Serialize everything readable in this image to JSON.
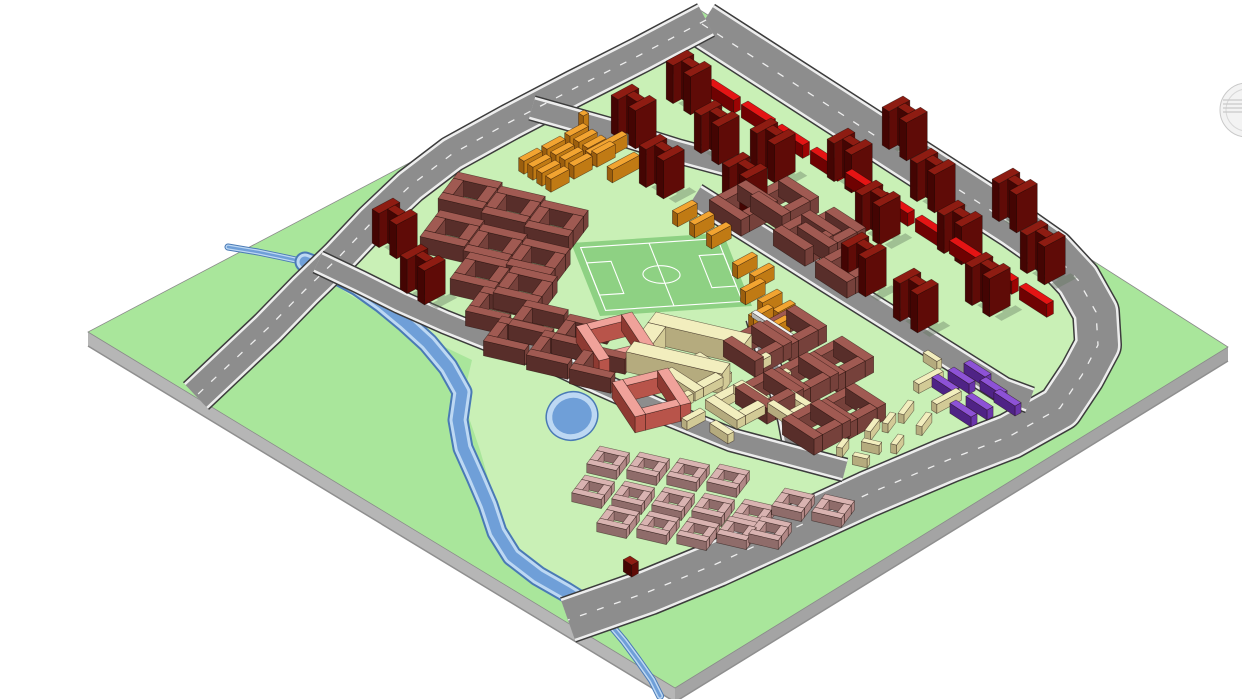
{
  "viewport": {
    "width": 1242,
    "height": 699,
    "background": "#ffffff",
    "type": "3d-axonometric-site-plan-viewport"
  },
  "icons": {
    "navigation_wheel": {
      "cx": 1247,
      "cy": 110,
      "r": 27,
      "stroke": "#c9c9c9",
      "fill": "#f3f3f3"
    }
  },
  "colors": {
    "terrain": "#a9e69b",
    "parcel": "#c9f0b6",
    "pitch": "#8ed183",
    "road": "#8d8d8d",
    "road_edge": "#3c3c3c",
    "sidewalk": "#ededed",
    "dash": "#ffffff",
    "plate_side_sw": "#b6b6b6",
    "plate_side_se": "#a4a4a4",
    "plate_stroke": "#8a8a8a",
    "water": "#6f9fd8",
    "water_bank": "#bdd8f3",
    "water_edge": "#4a7ab5",
    "shadow": "rgba(100,120,95,0.40)",
    "outline": "#1a0a06"
  },
  "palette": {
    "dr": [
      "#8e1c12",
      "#5f0b07",
      "#440503"
    ],
    "rd": [
      "#e41414",
      "#9c0404",
      "#6f0202"
    ],
    "br": [
      "#a05a52",
      "#76413b",
      "#582e2a"
    ],
    "or": [
      "#f2a431",
      "#c07a14",
      "#9c5f0e"
    ],
    "cr": [
      "#f2eebe",
      "#d2ca96",
      "#b5ab7e"
    ],
    "sa": [
      "#f0a29a",
      "#b8544a",
      "#8e3a32"
    ],
    "pk": [
      "#d9b3b1",
      "#b18886",
      "#8f6c6a"
    ],
    "pu": [
      "#8d52d6",
      "#6a35ab",
      "#4f2385"
    ],
    "wt": [
      "#f2f2f0",
      "#cfcfcc",
      "#b5b5b2"
    ]
  },
  "axes": {
    "d1": [
      0.528,
      0.342
    ],
    "d2": [
      -0.612,
      0.328
    ]
  },
  "plate": {
    "top": [
      [
        700,
        10
      ],
      [
        1228,
        347
      ],
      [
        675,
        688
      ],
      [
        88,
        332
      ]
    ],
    "thickness": 14
  },
  "dev_area": [
    [
      697,
      32
    ],
    [
      1000,
      228
    ],
    [
      1062,
      272
    ],
    [
      1080,
      315
    ],
    [
      1070,
      352
    ],
    [
      1040,
      398
    ],
    [
      966,
      436
    ],
    [
      880,
      472
    ],
    [
      800,
      505
    ],
    [
      716,
      545
    ],
    [
      648,
      575
    ],
    [
      575,
      600
    ],
    [
      540,
      575
    ],
    [
      515,
      545
    ],
    [
      500,
      515
    ],
    [
      490,
      485
    ],
    [
      480,
      450
    ],
    [
      468,
      415
    ],
    [
      465,
      390
    ],
    [
      472,
      360
    ],
    [
      430,
      340
    ],
    [
      390,
      318
    ],
    [
      350,
      295
    ],
    [
      310,
      268
    ],
    [
      350,
      233
    ],
    [
      395,
      197
    ],
    [
      440,
      165
    ],
    [
      490,
      138
    ],
    [
      540,
      112
    ],
    [
      590,
      85
    ],
    [
      640,
      60
    ]
  ],
  "field": {
    "tl": [
      571,
      243
    ],
    "tr": [
      723,
      233
    ],
    "bl": [
      600,
      316
    ],
    "border": [
      0.05,
      0.07,
      0.9,
      0.86
    ],
    "mid_x": 0.5,
    "circle": [
      0.5,
      0.5,
      0.12
    ],
    "box_left": [
      0.05,
      0.28,
      0.16,
      0.44
    ],
    "box_right": [
      0.79,
      0.28,
      0.16,
      0.44
    ]
  },
  "river": {
    "upper": [
      [
        228,
        247
      ],
      [
        258,
        252
      ],
      [
        282,
        257
      ],
      [
        305,
        262
      ]
    ],
    "main": [
      [
        305,
        262
      ],
      [
        332,
        272
      ],
      [
        358,
        286
      ],
      [
        382,
        303
      ],
      [
        405,
        322
      ],
      [
        428,
        343
      ],
      [
        448,
        367
      ],
      [
        462,
        392
      ],
      [
        458,
        420
      ],
      [
        463,
        448
      ],
      [
        476,
        477
      ],
      [
        488,
        505
      ],
      [
        497,
        532
      ],
      [
        512,
        556
      ],
      [
        538,
        576
      ],
      [
        566,
        592
      ],
      [
        590,
        607
      ]
    ],
    "lower": [
      [
        590,
        607
      ],
      [
        608,
        622
      ],
      [
        624,
        641
      ],
      [
        638,
        660
      ],
      [
        652,
        680
      ],
      [
        660,
        696
      ]
    ],
    "pond": {
      "cx": 572,
      "cy": 416,
      "rx": 26,
      "ry": 24,
      "rot": -20
    }
  },
  "roads": [
    {
      "name": "arterial-loop-road",
      "w": 40,
      "dash": true,
      "pts": [
        [
          702,
          24
        ],
        [
          1015,
          226
        ],
        [
          1052,
          252
        ],
        [
          1078,
          280
        ],
        [
          1096,
          312
        ],
        [
          1098,
          345
        ],
        [
          1082,
          375
        ],
        [
          1060,
          408
        ],
        [
          1010,
          436
        ],
        [
          948,
          460
        ],
        [
          868,
          494
        ],
        [
          790,
          530
        ],
        [
          716,
          564
        ],
        [
          648,
          592
        ],
        [
          568,
          620
        ]
      ]
    },
    {
      "name": "west-road",
      "w": 30,
      "dash": true,
      "pts": [
        [
          706,
          20
        ],
        [
          640,
          55
        ],
        [
          575,
          88
        ],
        [
          510,
          122
        ],
        [
          452,
          154
        ],
        [
          410,
          186
        ],
        [
          372,
          222
        ],
        [
          338,
          258
        ],
        [
          305,
          290
        ],
        [
          268,
          328
        ],
        [
          232,
          362
        ],
        [
          196,
          396
        ]
      ]
    },
    {
      "name": "street-h1a",
      "w": 18,
      "dash": false,
      "pts": [
        [
          532,
          108
        ],
        [
          610,
          130
        ],
        [
          677,
          151
        ],
        [
          755,
          172
        ]
      ]
    },
    {
      "name": "street-h1b",
      "w": 20,
      "dash": false,
      "pts": [
        [
          695,
          196
        ],
        [
          762,
          238
        ],
        [
          828,
          280
        ],
        [
          900,
          325
        ],
        [
          1003,
          390
        ],
        [
          1030,
          400
        ]
      ]
    },
    {
      "name": "street-v1",
      "w": 14,
      "dash": false,
      "pts": [
        [
          756,
          318
        ],
        [
          766,
          352
        ],
        [
          778,
          386
        ],
        [
          788,
          420
        ],
        [
          794,
          452
        ]
      ]
    },
    {
      "name": "street-h2",
      "w": 17,
      "dash": false,
      "pts": [
        [
          318,
          262
        ],
        [
          360,
          282
        ],
        [
          400,
          302
        ],
        [
          445,
          322
        ],
        [
          490,
          340
        ],
        [
          545,
          358
        ],
        [
          600,
          384
        ],
        [
          663,
          412
        ],
        [
          732,
          440
        ],
        [
          800,
          458
        ],
        [
          845,
          470
        ]
      ]
    }
  ],
  "modules": {
    "H": [
      [
        0,
        0,
        13,
        34
      ],
      [
        13,
        8,
        20,
        12
      ],
      [
        33,
        0,
        13,
        34
      ]
    ],
    "ring": [
      [
        0,
        0,
        60,
        14
      ],
      [
        0,
        14,
        14,
        32
      ],
      [
        46,
        14,
        14,
        32
      ],
      [
        0,
        46,
        60,
        14
      ]
    ],
    "ringS": [
      [
        0,
        0,
        40,
        10
      ],
      [
        0,
        10,
        10,
        20
      ],
      [
        30,
        10,
        10,
        20
      ],
      [
        0,
        30,
        40,
        10
      ]
    ],
    "Cc": [
      [
        0,
        0,
        56,
        13
      ],
      [
        0,
        13,
        13,
        30
      ],
      [
        0,
        43,
        56,
        13
      ]
    ],
    "Cbig": [
      [
        0,
        0,
        130,
        24
      ],
      [
        0,
        24,
        24,
        42
      ],
      [
        0,
        66,
        130,
        24
      ]
    ],
    "ringT": [
      [
        0,
        0,
        80,
        14
      ],
      [
        0,
        14,
        14,
        46
      ],
      [
        66,
        14,
        14,
        46
      ],
      [
        0,
        60,
        80,
        14
      ]
    ],
    "bar": null
  },
  "buildings": [
    {
      "module": "H",
      "color": "dr",
      "h": 38,
      "rot": 0,
      "anchors": [
        [
          632,
          84
        ],
        [
          687,
          50
        ],
        [
          660,
          134
        ],
        [
          715,
          100
        ],
        [
          743,
          152
        ],
        [
          771,
          118
        ],
        [
          848,
          128
        ],
        [
          903,
          96
        ],
        [
          876,
          180
        ],
        [
          931,
          148
        ],
        [
          958,
          200
        ],
        [
          1013,
          168
        ],
        [
          986,
          252
        ],
        [
          1041,
          220
        ],
        [
          862,
          232
        ],
        [
          914,
          268
        ]
      ]
    },
    {
      "module": "H",
      "color": "dr",
      "h": 34,
      "rot": 0,
      "anchors": [
        [
          393,
          198
        ],
        [
          421,
          244
        ]
      ]
    },
    {
      "module": "bar",
      "color": "dr",
      "h": 12,
      "rot": 0,
      "size": [
        16,
        11
      ],
      "anchors": [
        [
          630,
          556
        ]
      ]
    },
    {
      "module": "bar",
      "color": "rd",
      "h": 13,
      "rot": 0,
      "size": [
        52,
        11
      ],
      "anchors": [
        [
          678,
          56
        ],
        [
          713,
          79
        ],
        [
          748,
          101
        ],
        [
          782,
          124
        ],
        [
          817,
          147
        ],
        [
          852,
          169
        ],
        [
          887,
          192
        ],
        [
          922,
          215
        ],
        [
          956,
          237
        ],
        [
          991,
          260
        ],
        [
          1026,
          283
        ]
      ]
    },
    {
      "module": "ring",
      "color": "br",
      "h": 16,
      "rot": 0,
      "anchors": [
        [
          787,
          176
        ],
        [
          834,
          207
        ],
        [
          746,
          180
        ],
        [
          810,
          210
        ],
        [
          852,
          242
        ]
      ]
    },
    {
      "module": "ring",
      "color": "br",
      "h": 16,
      "rot": 0,
      "anchors": [
        [
          795,
          305
        ],
        [
          842,
          336
        ],
        [
          760,
          321
        ],
        [
          807,
          352
        ],
        [
          854,
          383
        ],
        [
          772,
          368
        ],
        [
          819,
          399
        ]
      ]
    },
    {
      "module": "Cc",
      "color": "br",
      "h": 15,
      "rot": -25,
      "anchors": [
        [
          484,
          286
        ],
        [
          527,
          300
        ],
        [
          570,
          314
        ],
        [
          502,
          316
        ],
        [
          545,
          330
        ],
        [
          588,
          344
        ]
      ]
    },
    {
      "module": "ring",
      "color": "br",
      "h": 16,
      "rot": -25,
      "anchors": [
        [
          458,
          172
        ],
        [
          501,
          186
        ],
        [
          544,
          200
        ],
        [
          440,
          210
        ],
        [
          483,
          224
        ],
        [
          526,
          238
        ],
        [
          470,
          252
        ],
        [
          513,
          266
        ]
      ]
    },
    {
      "module": "bar",
      "color": "or",
      "h": 13,
      "rot": 0,
      "size": [
        10,
        30
      ],
      "anchors": [
        [
          583,
          123
        ],
        [
          592,
          129
        ],
        [
          601,
          135
        ],
        [
          610,
          141
        ],
        [
          560,
          136
        ],
        [
          569,
          142
        ],
        [
          578,
          147
        ],
        [
          587,
          153
        ],
        [
          537,
          148
        ],
        [
          546,
          154
        ],
        [
          555,
          160
        ],
        [
          564,
          166
        ]
      ]
    },
    {
      "module": "bar",
      "color": "or",
      "h": 13,
      "rot": 0,
      "size": [
        10,
        60
      ],
      "anchors": [
        [
          622,
          131
        ]
      ]
    },
    {
      "module": "bar",
      "color": "or",
      "h": 13,
      "rot": 0,
      "size": [
        10,
        44
      ],
      "anchors": [
        [
          634,
          152
        ]
      ]
    },
    {
      "module": "bar",
      "color": "or",
      "h": 17,
      "rot": 0,
      "size": [
        9,
        9
      ],
      "anchors": [
        [
          584,
          110
        ]
      ]
    },
    {
      "module": "bar",
      "color": "or",
      "h": 13,
      "rot": 0,
      "size": [
        10,
        32
      ],
      "anchors": [
        [
          692,
          200
        ],
        [
          709,
          211
        ],
        [
          726,
          222
        ],
        [
          752,
          252
        ],
        [
          769,
          263
        ],
        [
          760,
          278
        ],
        [
          777,
          289
        ],
        [
          768,
          304
        ],
        [
          785,
          315
        ]
      ]
    },
    {
      "module": "bar",
      "color": "or",
      "h": 13,
      "rot": 0,
      "size": [
        30,
        10
      ],
      "anchors": [
        [
          770,
          326
        ]
      ]
    },
    {
      "module": "bar",
      "color": "or",
      "h": 13,
      "rot": 0,
      "size": [
        10,
        28
      ],
      "anchors": [
        [
          790,
          300
        ]
      ]
    },
    {
      "module": "bar",
      "color": "wt",
      "h": 5,
      "rot": 0,
      "size": [
        100,
        7
      ],
      "anchors": [
        [
          756,
          310
        ]
      ]
    },
    {
      "module": "ring",
      "color": "cr",
      "h": 9,
      "rot": 0,
      "anchors": [
        [
          700,
          352
        ],
        [
          742,
          380
        ]
      ]
    },
    {
      "module": "ringS",
      "color": "cr",
      "h": 9,
      "rot": 0,
      "anchors": [
        [
          792,
          390
        ]
      ]
    },
    {
      "module": "bar",
      "color": "cr",
      "h": 9,
      "rot": 0,
      "size": null,
      "anchors": [
        [
          700,
          408,
          10,
          30
        ],
        [
          716,
          420,
          34,
          10
        ],
        [
          766,
          352,
          10,
          30
        ],
        [
          786,
          368,
          10,
          30
        ],
        [
          688,
          390,
          10,
          24
        ],
        [
          938,
          368,
          10,
          40
        ],
        [
          956,
          388,
          10,
          40
        ],
        [
          928,
          350,
          26,
          8
        ]
      ]
    },
    {
      "module": "bar",
      "color": "cr",
      "h": 9,
      "rot": -25,
      "size": null,
      "anchors": [
        [
          858,
          408,
          8,
          28
        ],
        [
          874,
          418,
          8,
          28
        ],
        [
          890,
          412,
          8,
          24
        ],
        [
          864,
          438,
          24,
          8
        ],
        [
          898,
          434,
          8,
          22
        ],
        [
          908,
          400,
          8,
          30
        ],
        [
          926,
          412,
          8,
          30
        ],
        [
          843,
          438,
          8,
          20
        ],
        [
          855,
          452,
          20,
          8
        ]
      ]
    },
    {
      "module": "Cbig",
      "color": "cr",
      "h": 20,
      "rot": -25,
      "anchors": [
        [
          656,
          312
        ]
      ]
    },
    {
      "module": "ringT",
      "color": "sa",
      "h": 16,
      "rot": 20,
      "anchors": [
        [
          632,
          312
        ],
        [
          668,
          368
        ]
      ]
    },
    {
      "module": "ringS",
      "color": "pk",
      "h": 9,
      "rot": -25,
      "anchors": [
        [
          600,
          446
        ],
        [
          640,
          452
        ],
        [
          680,
          458
        ],
        [
          720,
          464
        ],
        [
          585,
          475
        ],
        [
          625,
          481
        ],
        [
          665,
          487
        ],
        [
          705,
          493
        ],
        [
          745,
          499
        ],
        [
          610,
          505
        ],
        [
          650,
          511
        ],
        [
          690,
          517
        ],
        [
          730,
          516
        ],
        [
          785,
          488
        ],
        [
          825,
          494
        ],
        [
          762,
          516
        ]
      ]
    },
    {
      "module": "bar",
      "color": "pu",
      "h": 10,
      "rot": 0,
      "size": [
        40,
        10
      ],
      "anchors": [
        [
          938,
          374
        ],
        [
          954,
          367
        ],
        [
          970,
          360
        ],
        [
          986,
          377
        ],
        [
          1000,
          389
        ],
        [
          956,
          400
        ],
        [
          972,
          393
        ]
      ]
    }
  ]
}
